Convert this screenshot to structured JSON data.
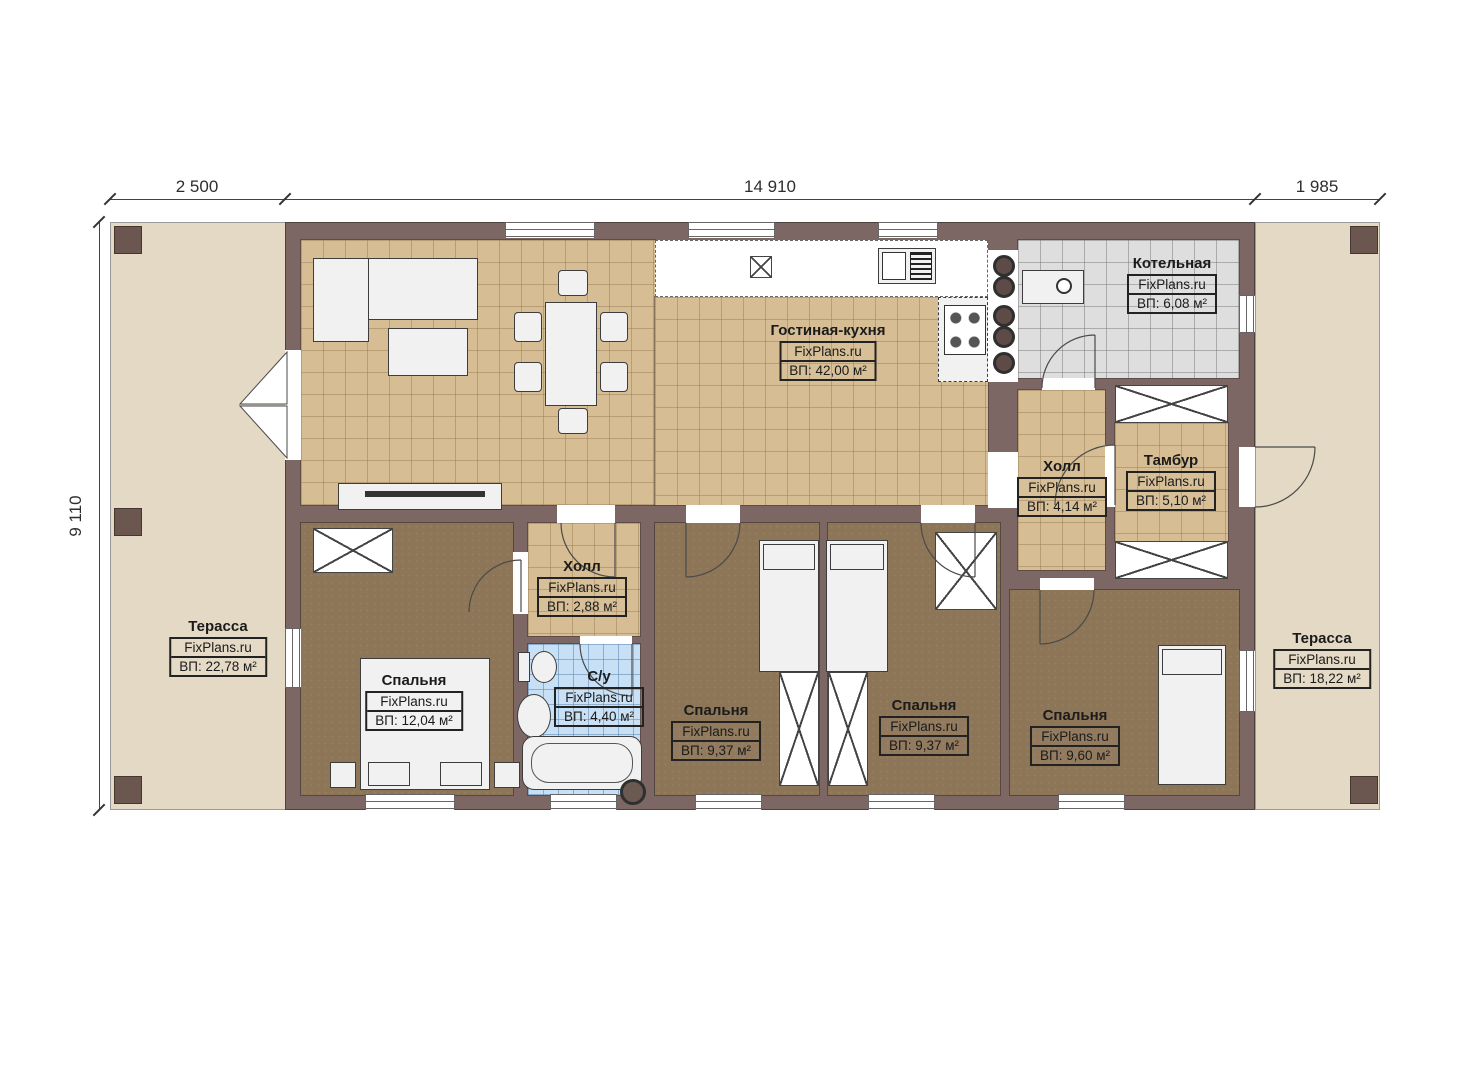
{
  "plan": {
    "watermark": "FixPlans.ru",
    "dimensions": {
      "top_left": "2 500",
      "top_middle": "14 910",
      "top_right": "1 985",
      "left_side": "9 110"
    },
    "rooms": [
      {
        "name": "Гостиная-кухня",
        "area": "ВП: 42,00 м²"
      },
      {
        "name": "Котельная",
        "area": "ВП: 6,08 м²"
      },
      {
        "name": "Холл",
        "area": "ВП: 4,14 м²"
      },
      {
        "name": "Тамбур",
        "area": "ВП: 5,10 м²"
      },
      {
        "name": "Холл",
        "area": "ВП: 2,88 м²"
      },
      {
        "name": "С/у",
        "area": "ВП: 4,40 м²"
      },
      {
        "name": "Спальня",
        "area": "ВП: 12,04 м²"
      },
      {
        "name": "Спальня",
        "area": "ВП: 9,37 м²"
      },
      {
        "name": "Спальня",
        "area": "ВП: 9,37 м²"
      },
      {
        "name": "Спальня",
        "area": "ВП: 9,60 м²"
      },
      {
        "name": "Терасса",
        "area": "ВП: 22,78 м²"
      },
      {
        "name": "Терасса",
        "area": "ВП: 18,22 м²"
      }
    ],
    "colors": {
      "wall": "#7d6764",
      "terrace": "#e4d9c4",
      "floor_tile_tan": "#d6bd94",
      "floor_wood_brown": "#8d7557",
      "floor_tile_gray": "#dedede",
      "floor_tile_blue": "#c8e0f5"
    }
  }
}
